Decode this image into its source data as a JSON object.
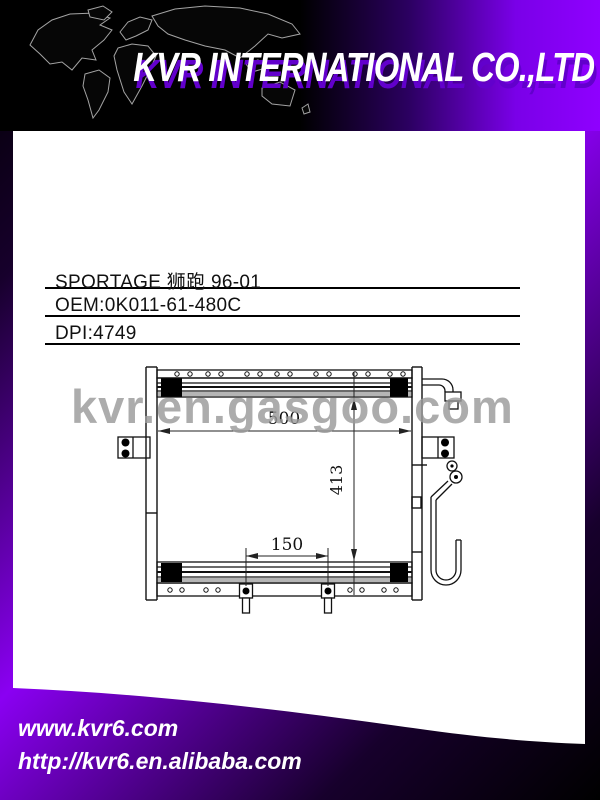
{
  "banner": {
    "company": "KVR INTERNATIONAL CO.,LTD"
  },
  "product": {
    "title": "SPORTAGE 狮跑  96-01",
    "oem": "OEM:0K011-61-480C",
    "dpi": "DPI:4749"
  },
  "watermark": {
    "text": "kvr.en.gasgoo.com"
  },
  "diagram": {
    "part_type": "condenser-technical-drawing",
    "dimensions": {
      "width_mm": "500",
      "height_mm": "413",
      "mount_pitch_mm": "150"
    }
  },
  "footer": {
    "site1": "www.kvr6.com",
    "site2": "http://kvr6.en.alibaba.com"
  },
  "colors": {
    "accent_purple": "#8a00f2",
    "banner_shadow_purple": "#6200cc",
    "watermark_gray": "#9b9b9b",
    "background_black": "#000000",
    "card_white": "#ffffff"
  }
}
